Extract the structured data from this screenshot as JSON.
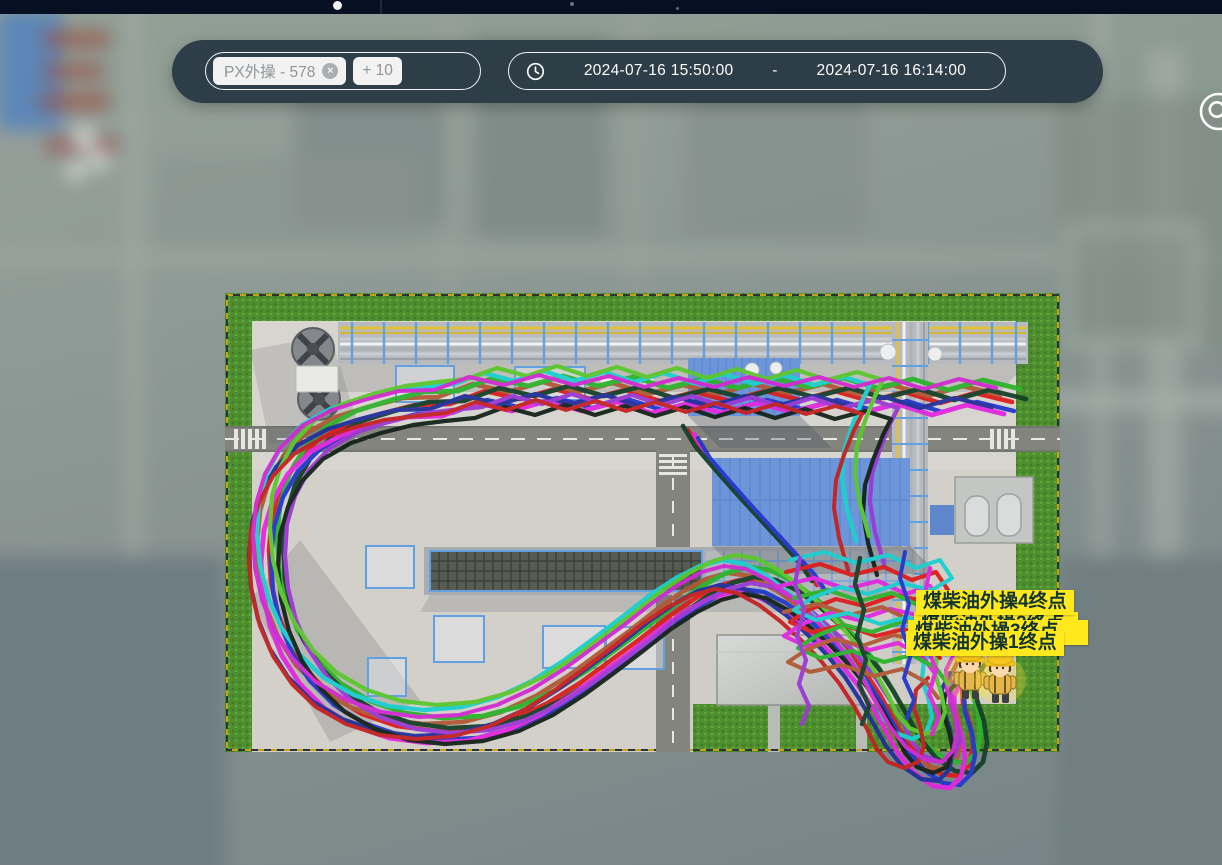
{
  "toolbar": {
    "tags_input": {
      "chips": [
        {
          "label": "PX外操 - 578",
          "remove_icon": "×"
        }
      ],
      "more_chip_label": "+ 10"
    },
    "time_range": {
      "start": "2024-07-16 15:50:00",
      "separator": "-",
      "end": "2024-07-16 16:14:00"
    },
    "locate_button": {
      "icon": "target-search-icon"
    }
  },
  "map": {
    "endpoint_labels": [
      {
        "text": "煤柴油外操4终点"
      },
      {
        "text": "煤柴油外操2终点",
        "clipped": true
      },
      {
        "text": "煤柴油外操3终点",
        "clipped": true
      },
      {
        "text": "煤柴油外操1终点"
      }
    ],
    "workers_at_endpoint": 2,
    "trails": {
      "main": [
        {
          "c": "#dc1f1d",
          "p": "a",
          "dx": 0,
          "dy": 0,
          "w": 4.6
        },
        {
          "c": "#b05a36",
          "p": "a",
          "dx": -12,
          "dy": -7,
          "w": 4.6
        },
        {
          "c": "#2db32d",
          "p": "a",
          "dx": 8,
          "dy": -13,
          "w": 4.8
        },
        {
          "c": "#17402a",
          "p": "a",
          "dx": 14,
          "dy": -3,
          "w": 4.6
        },
        {
          "c": "#2438cc",
          "p": "a",
          "dx": 2,
          "dy": 9,
          "w": 4.4
        },
        {
          "c": "#e228de",
          "p": "a",
          "dx": -8,
          "dy": 12,
          "w": 4.8
        },
        {
          "c": "#23309a",
          "p": "a",
          "dx": -20,
          "dy": 5,
          "w": 4.2
        },
        {
          "c": "#9c3ad4",
          "p": "b",
          "dx": 12,
          "dy": 4,
          "w": 4.2
        },
        {
          "c": "#1ccfcf",
          "p": "b",
          "dx": -16,
          "dy": -19,
          "w": 4.4
        },
        {
          "c": "#15231a",
          "p": "b",
          "dx": 5,
          "dy": 15,
          "w": 4.2
        },
        {
          "c": "#5cc72e",
          "p": "b",
          "dx": -3,
          "dy": -24,
          "w": 4.2
        },
        {
          "c": "#c42222",
          "p": "b",
          "dx": -24,
          "dy": 10,
          "w": 4.0
        },
        {
          "c": "#d12ad1",
          "p": "a",
          "dx": -16,
          "dy": -14,
          "w": 4.0
        }
      ],
      "cross": [
        {
          "c": "#dc1f1d",
          "dx": 0,
          "dy": 0,
          "w": 4.6
        },
        {
          "c": "#e228de",
          "dx": 6,
          "dy": 4,
          "w": 4.4
        },
        {
          "c": "#17402a",
          "dx": -5,
          "dy": -4,
          "w": 4.6
        },
        {
          "c": "#2438cc",
          "dx": 10,
          "dy": 8,
          "w": 4.0
        }
      ],
      "tangle": [
        {
          "c": "#dc1f1d",
          "dx": 0,
          "dy": 0,
          "w": 4.2
        },
        {
          "c": "#e228de",
          "dx": -6,
          "dy": 14,
          "w": 4.2
        },
        {
          "c": "#2db32d",
          "dx": 8,
          "dy": 26,
          "w": 4.2
        },
        {
          "c": "#b05a36",
          "dx": -2,
          "dy": 40,
          "w": 4.0
        },
        {
          "c": "#1ccfcf",
          "dx": 4,
          "dy": -12,
          "w": 4.0
        }
      ],
      "vertical": [
        {
          "c": "#9c3ad4",
          "dx": 0,
          "dy": 0,
          "w": 4.2
        },
        {
          "c": "#17402a",
          "dx": 60,
          "dy": 0,
          "w": 4.4
        },
        {
          "c": "#2438cc",
          "dx": 105,
          "dy": -6,
          "w": 4.0
        },
        {
          "c": "#e228de",
          "dx": 130,
          "dy": 10,
          "w": 4.2
        }
      ]
    }
  }
}
